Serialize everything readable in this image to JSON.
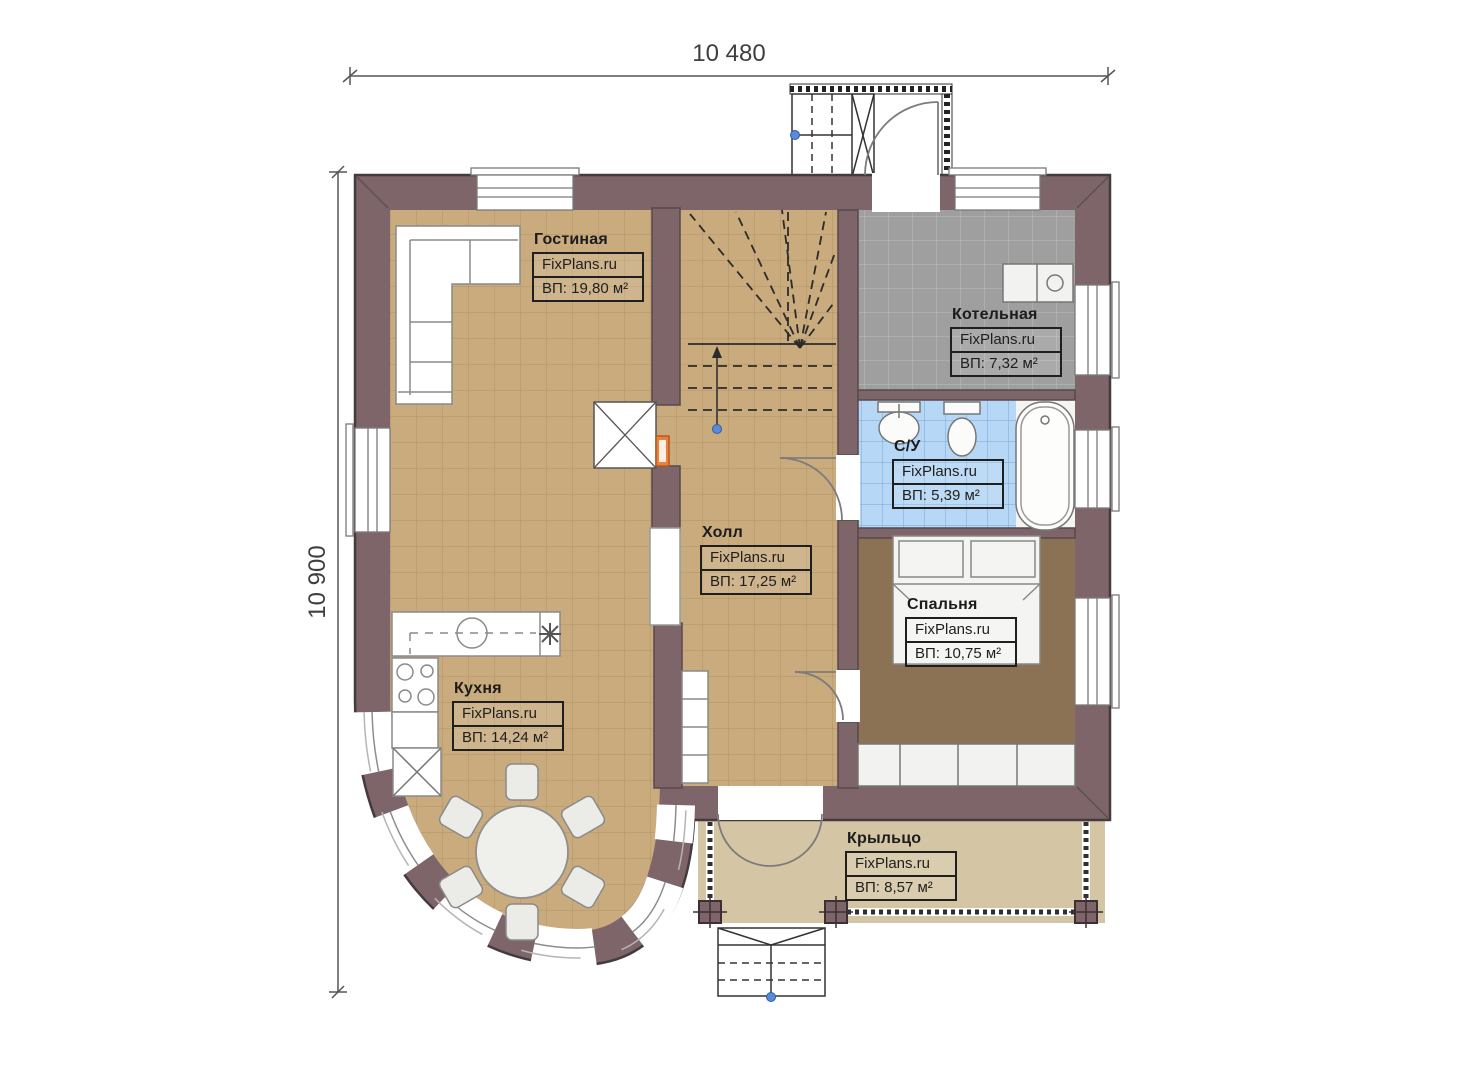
{
  "plan": {
    "dimensions": {
      "width_label": "10 480",
      "height_label": "10 900"
    },
    "watermark": "FixPlans.ru",
    "rooms": [
      {
        "name": "Гостиная",
        "watermark": "FixPlans.ru",
        "area": "ВП: 19,80 м²"
      },
      {
        "name": "Котельная",
        "watermark": "FixPlans.ru",
        "area": "ВП: 7,32 м²"
      },
      {
        "name": "С/У",
        "watermark": "FixPlans.ru",
        "area": "ВП: 5,39 м²"
      },
      {
        "name": "Холл",
        "watermark": "FixPlans.ru",
        "area": "ВП: 17,25 м²"
      },
      {
        "name": "Спальня",
        "watermark": "FixPlans.ru",
        "area": "ВП: 10,75 м²"
      },
      {
        "name": "Кухня",
        "watermark": "FixPlans.ru",
        "area": "ВП: 14,24 м²"
      },
      {
        "name": "Крыльцо",
        "watermark": "FixPlans.ru",
        "area": "ВП: 8,57 м²"
      }
    ],
    "colors": {
      "wall": "#7d6569",
      "floor_tile_tan": "#c9ab7e",
      "floor_tile_gray": "#9f9f9f",
      "floor_tile_blue": "#b6d7f5",
      "floor_bedroom": "#8b7254",
      "floor_porch": "#d4c5a4",
      "radiator_orange": "#e8813b",
      "marker_blue": "#5b8bd8"
    }
  }
}
